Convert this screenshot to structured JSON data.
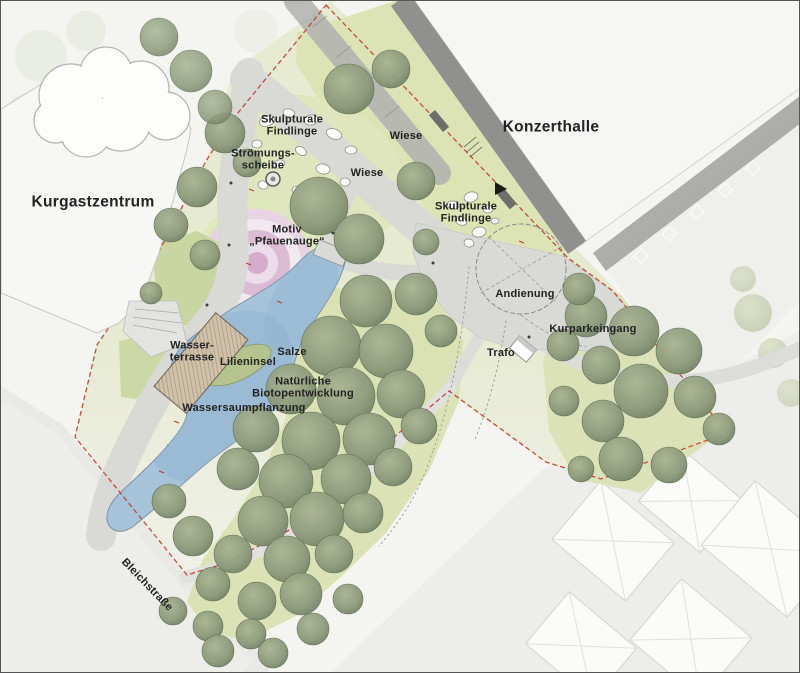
{
  "plan": {
    "type": "landscape-site-plan",
    "labels": {
      "kurgastzentrum": "Kurgastzentrum",
      "konzerthalle": "Konzerthalle",
      "skulpturale_findlinge_top": "Skulpturale\nFindlinge",
      "stroemungsscheibe": "Strömungs-\nscheibe",
      "wiese_top": "Wiese",
      "wiese_mid": "Wiese",
      "skulpturale_findlinge_right": "Skulpturale\nFindlinge",
      "motiv_pfauenauge": "Motiv\n„Pfauenauge“",
      "andienung": "Andienung",
      "kurparkeingang": "Kurparkeingang",
      "trafo": "Trafo",
      "wasserterrasse": "Wasser-\nterrasse",
      "lilieninsel": "Lilieninsel",
      "salze": "Salze",
      "biotopentwicklung": "Natürliche\nBiotopentwicklung",
      "wassersaumpflanzung": "Wassersaumpflanzung",
      "bleichstrasse": "Bleichstraße"
    },
    "colors": {
      "water": "#a7c3da",
      "meadow": "#dce4b6",
      "tree_green": "#8e9a7c",
      "path_gray": "#d9d9d5",
      "boundary_red": "#c23b2a",
      "motif_pink": "#dcb9d6",
      "building_white": "#f7f7f6",
      "band_gray": "#90918f"
    }
  }
}
